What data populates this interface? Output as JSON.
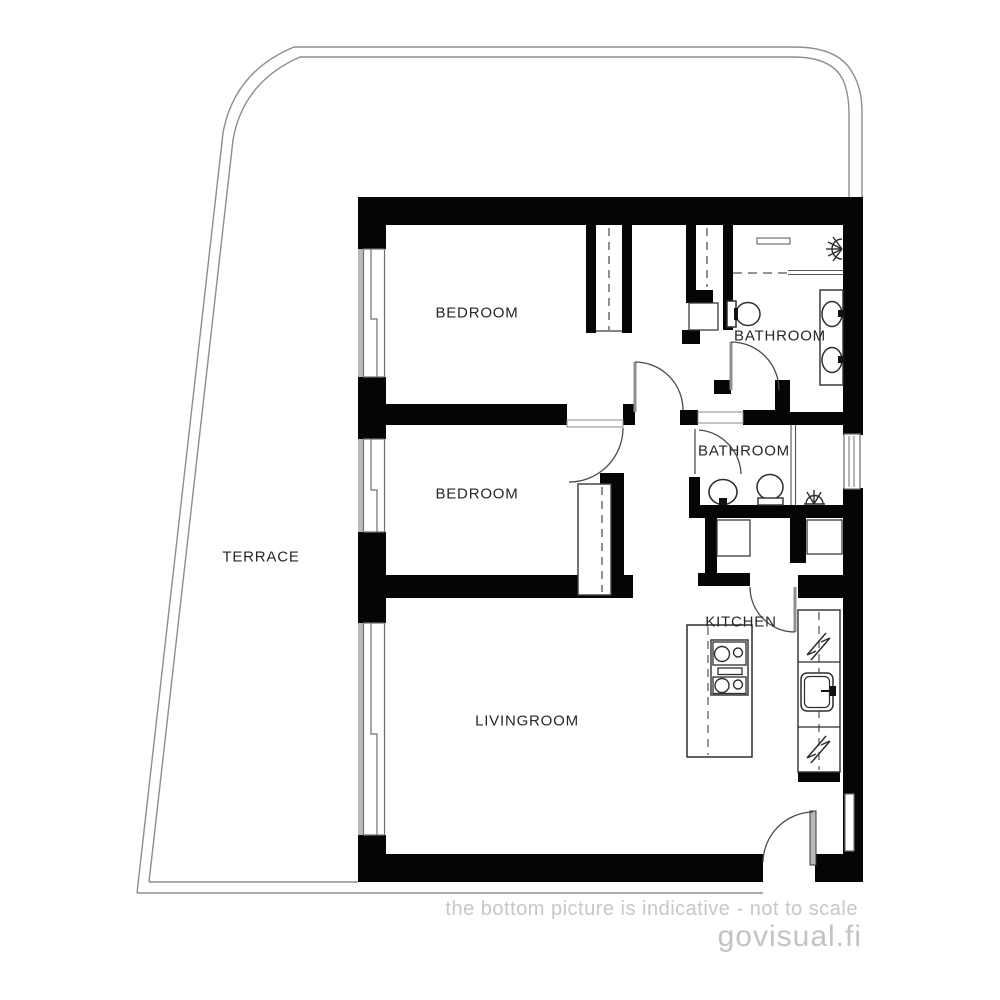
{
  "plan": {
    "rooms": {
      "terrace": {
        "label": "TERRACE"
      },
      "bedroom_top": {
        "label": "BEDROOM"
      },
      "bathroom_top": {
        "label": "BATHROOM"
      },
      "bedroom_middle": {
        "label": "BEDROOM"
      },
      "bathroom_middle": {
        "label": "BATHROOM"
      },
      "kitchen": {
        "label": "KITCHEN"
      },
      "livingroom": {
        "label": "LIVINGROOM"
      }
    },
    "fixtures": [
      "toilet-icon",
      "double-sink-icon",
      "shower-head-icon",
      "round-sink-icon",
      "floor-drain-icon",
      "stove-icon",
      "kitchen-sink-icon",
      "electrical-appliance-icon",
      "wardrobe",
      "closet-cabinet",
      "kitchen-island",
      "window",
      "door-swing"
    ],
    "colors": {
      "wall": "#050505",
      "line": "#3a3a3a",
      "light_line": "#9a9a9a",
      "label": "#262626",
      "muted_text": "#c5c5c5"
    }
  },
  "footer": {
    "disclaimer": "the bottom picture is indicative - not to scale",
    "watermark": "govisual.fi"
  }
}
